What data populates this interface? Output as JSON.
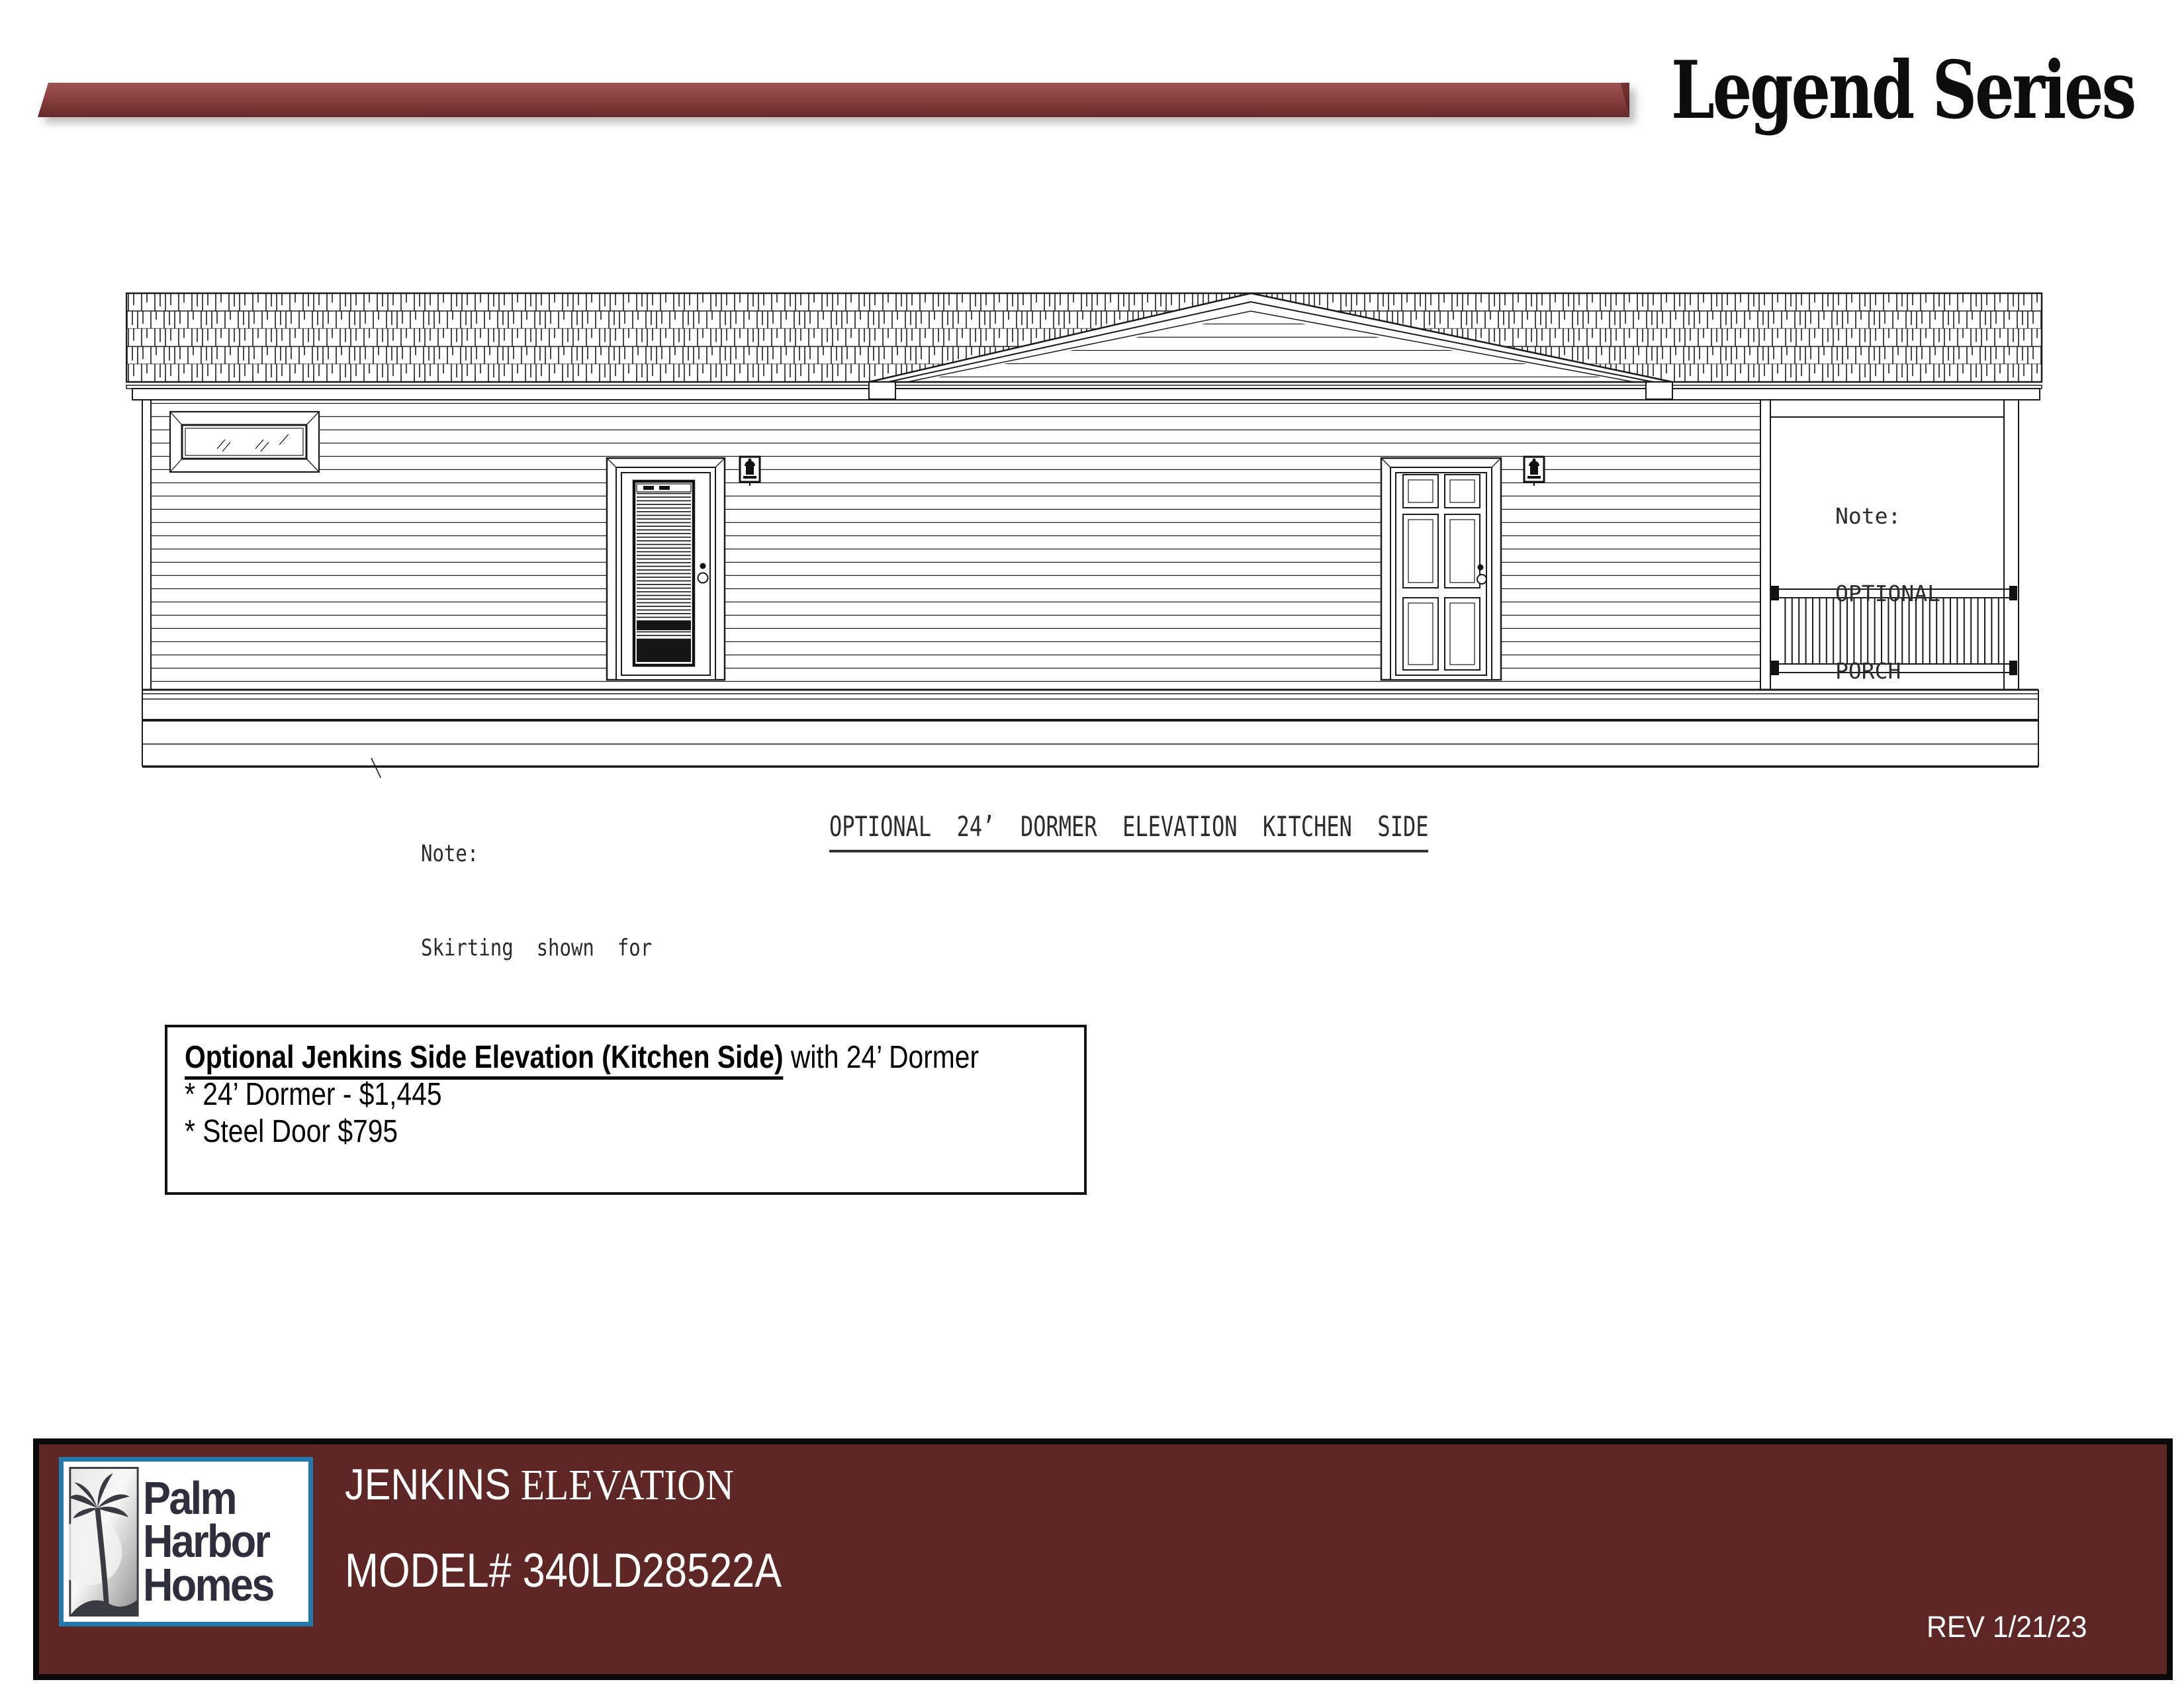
{
  "header": {
    "series_title": "Legend Series"
  },
  "drawing": {
    "porch_note_line1": "Note:",
    "porch_note_line2": "OPTIONAL",
    "porch_note_line3": "PORCH",
    "skirting_note_line1": "Note:",
    "skirting_note_line2": "Skirting  shown  for",
    "skirting_note_line3": "illustration  purposes  only",
    "caption": "OPTIONAL  24’  DORMER  ELEVATION  KITCHEN  SIDE"
  },
  "price_box": {
    "title_bold": "Optional Jenkins Side Elevation (Kitchen Side)",
    "title_rest": " with 24’ Dormer",
    "item1": "* 24’ Dormer - $1,445",
    "item2": "* Steel Door $795"
  },
  "footer": {
    "logo_line1": "Palm",
    "logo_line2": "Harbor",
    "logo_line3": "Homes",
    "title_primary": "JENKINS",
    "title_secondary": " ELEVATION",
    "model": "MODEL# 340LD28522A",
    "revision": "REV 1/21/23"
  },
  "colors": {
    "accent_bar_maroon": "#8a4040",
    "footer_maroon": "#5f2626",
    "logo_border_blue": "#2478ad",
    "drawing_ink": "#1a1a1a"
  }
}
